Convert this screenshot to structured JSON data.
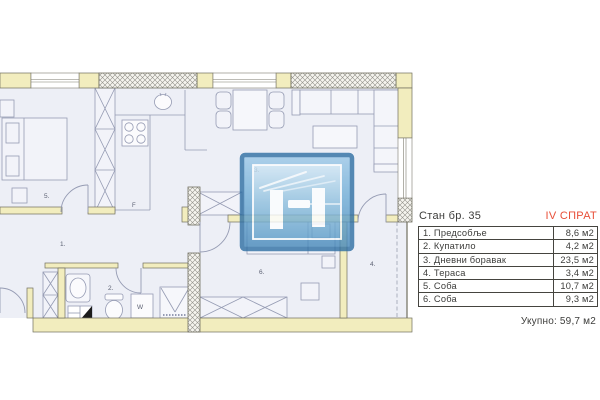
{
  "panel": {
    "title": "Стан бр. 35",
    "floor": "IV СПРАТ",
    "rows": [
      {
        "name": "1. Предсобље",
        "area": "8,6 м2"
      },
      {
        "name": "2. Купатило",
        "area": "4,2 м2"
      },
      {
        "name": "3. Дневни боравак",
        "area": "23,5 м2"
      },
      {
        "name": "4. Тераса",
        "area": "3,4 м2"
      },
      {
        "name": "5. Соба",
        "area": "10,7 м2"
      },
      {
        "name": "6. Соба",
        "area": "9,3 м2"
      }
    ],
    "total": "Укупно: 59,7 м2"
  },
  "plan": {
    "room_labels": {
      "hallway": "1.",
      "bathroom": "2.",
      "living_room": "3.",
      "terrace": "4.",
      "bedroom_1": "5.",
      "bedroom_2": "6."
    },
    "appliance_labels": {
      "fridge": "F",
      "washing_machine": "W"
    }
  },
  "colors": {
    "accent_red": "#e84f38",
    "wall_yellow": "#f2edbe",
    "floor_fill": "#edeff6",
    "logo_blue": "#4a8fc0",
    "table_text": "#3d3d3b"
  }
}
